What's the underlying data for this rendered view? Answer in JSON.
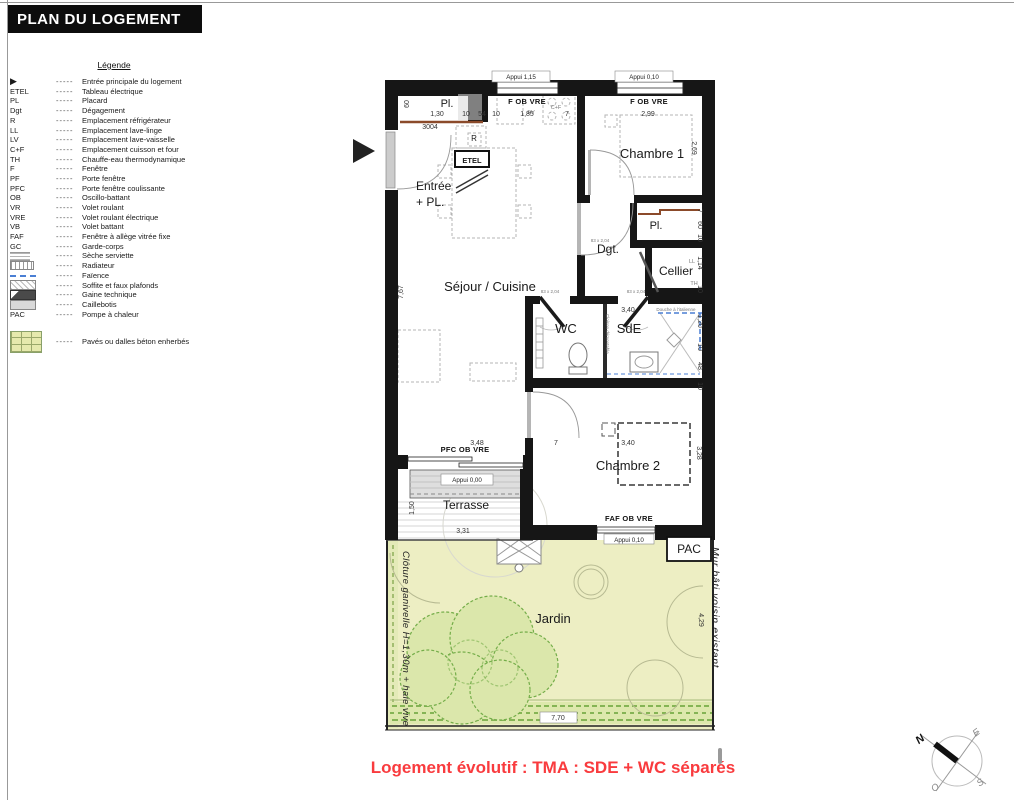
{
  "title": "PLAN DU LOGEMENT",
  "colors": {
    "accent_red": "#f93b3e",
    "wall_black": "#161616",
    "jardin_green": "#edeec3",
    "tree_green": "#6fae45",
    "faience_blue": "#4a7fd4",
    "soffite_brown": "#8b4a2a"
  },
  "legend": {
    "title": "Légende",
    "dash": "-----",
    "items": [
      {
        "abbr": "▶",
        "label": "Entrée principale du logement"
      },
      {
        "abbr": "ETEL",
        "label": "Tableau électrique"
      },
      {
        "abbr": "PL",
        "label": "Placard"
      },
      {
        "abbr": "Dgt",
        "label": "Dégagement"
      },
      {
        "abbr": "R",
        "label": "Emplacement réfrigérateur"
      },
      {
        "abbr": "LL",
        "label": "Emplacement lave-linge"
      },
      {
        "abbr": "LV",
        "label": "Emplacement lave-vaisselle"
      },
      {
        "abbr": "C+F",
        "label": "Emplacement cuisson et four"
      },
      {
        "abbr": "TH",
        "label": "Chauffe-eau thermodynamique"
      },
      {
        "abbr": "F",
        "label": "Fenêtre"
      },
      {
        "abbr": "PF",
        "label": "Porte fenêtre"
      },
      {
        "abbr": "PFC",
        "label": "Porte fenêtre coulissante"
      },
      {
        "abbr": "OB",
        "label": "Oscillo-battant"
      },
      {
        "abbr": "VR",
        "label": "Volet roulant"
      },
      {
        "abbr": "VRE",
        "label": "Volet roulant électrique"
      },
      {
        "abbr": "VB",
        "label": "Volet battant"
      },
      {
        "abbr": "FAF",
        "label": "Fenêtre à allège vitrée fixe"
      },
      {
        "abbr": "GC",
        "label": "Garde-corps"
      },
      {
        "symbol": "seche",
        "label": "Sèche serviette"
      },
      {
        "symbol": "radiateur",
        "label": "Radiateur"
      },
      {
        "symbol": "faience",
        "label": "Faïence"
      },
      {
        "symbol": "soffite",
        "label": "Soffite et faux plafonds"
      },
      {
        "symbol": "gaine",
        "label": "Gaine technique"
      },
      {
        "symbol": "caillebotis",
        "label": "Caillebotis"
      },
      {
        "abbr": "PAC",
        "label": "Pompe à chaleur"
      },
      {
        "symbol": "paves",
        "label": "Pavés ou dalles béton enherbés",
        "gap": true
      }
    ]
  },
  "plan": {
    "rooms": {
      "pl1": "Pl.",
      "entree1": "Entrée",
      "entree2": "+ PL.",
      "sejour": "Séjour / Cuisine",
      "chambre1": "Chambre 1",
      "pl2": "Pl.",
      "dgt": "Dgt.",
      "cellier": "Cellier",
      "wc": "WC",
      "sde": "SdE",
      "chambre2": "Chambre 2",
      "terrasse": "Terrasse",
      "jardin": "Jardin",
      "pac": "PAC"
    },
    "windows": {
      "appui_115": "Appui 1,15",
      "appui_010a": "Appui 0,10",
      "appui_000": "Appui 0,00",
      "appui_010b": "Appui 0,10",
      "f_ob_vre_a": "F OB VRE",
      "f_ob_vre_b": "F OB VRE",
      "pfc_ob_vre": "PFC OB VRE",
      "faf_ob_vre": "FAF OB VRE"
    },
    "dims": {
      "top": [
        "1,30",
        "10",
        "54",
        "10",
        "1,85",
        "7",
        "2,99"
      ],
      "left_60": "60",
      "left_767": "7,67",
      "right": [
        "2,69",
        "7",
        "60",
        "10",
        "1,14",
        "10",
        "1,20",
        "10",
        "48",
        "10",
        "3,28"
      ],
      "mid_348": "3,48",
      "mid_7": "7",
      "ch2_340": "3,40",
      "sde_340": "3,40",
      "ter_150": "1,50",
      "ter_331": "3,31",
      "jar_429": "4,29",
      "jar_770": "7,70"
    },
    "labels": {
      "unit": "3004",
      "r": "R",
      "etel": "ETEL",
      "ev": "EV",
      "cf": "C+F",
      "ll": "LL",
      "th": "TH",
      "douche": "Douche à l'italienne",
      "cloison": "Cloison démontable",
      "door_dgt": "83 x 2,04",
      "door_wc": "83 x 2,04",
      "door_sde": "83 x 2,04",
      "cloture": "Clôture ganivelle H=1,30m + haie vive",
      "mur": "Mur bâti voisin existant"
    }
  },
  "footer": {
    "note": "Logement évolutif : TMA : SDE + WC séparés"
  },
  "compass": {
    "n": "N",
    "e": "E",
    "s": "S",
    "o": "O"
  }
}
